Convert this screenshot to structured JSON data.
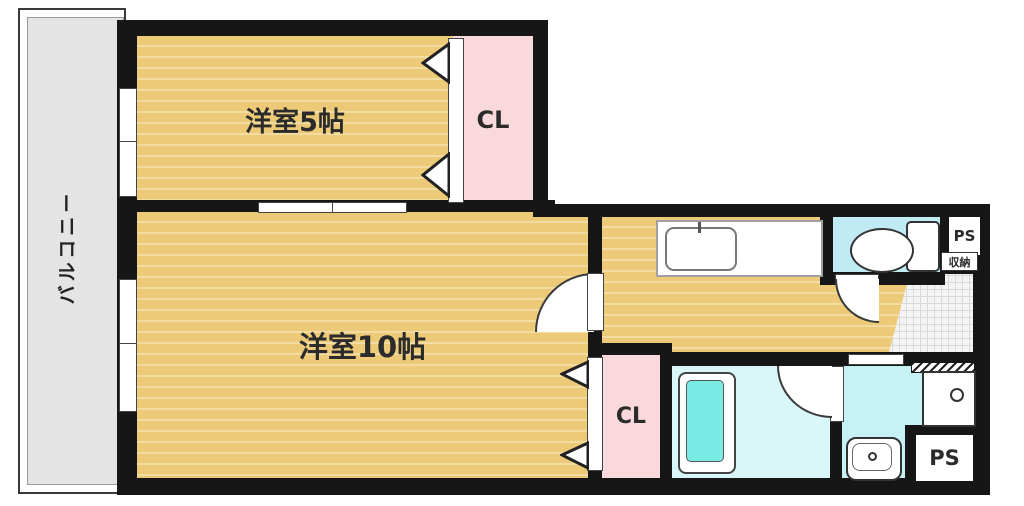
{
  "labels": {
    "balcony": "バルコニー",
    "room5": "洋室5帖",
    "room10": "洋室10帖",
    "closet_top": "CL",
    "closet_bottom": "CL",
    "pipe_space_top": "PS",
    "pipe_space_bottom": "PS",
    "storage": "収納"
  },
  "colors": {
    "wall": "#161616",
    "wood": "#ecca77",
    "wood_stripe": "#f3dca1",
    "pink": "#f9d9db",
    "toilet_blue": "#c0ebf5",
    "bath_blue": "#d9f6f8",
    "washroom_blue": "#c6f1f5",
    "tub": "#79ebe4",
    "balcony_gray": "#e4e4e4",
    "tile": "#f4f4f4"
  }
}
